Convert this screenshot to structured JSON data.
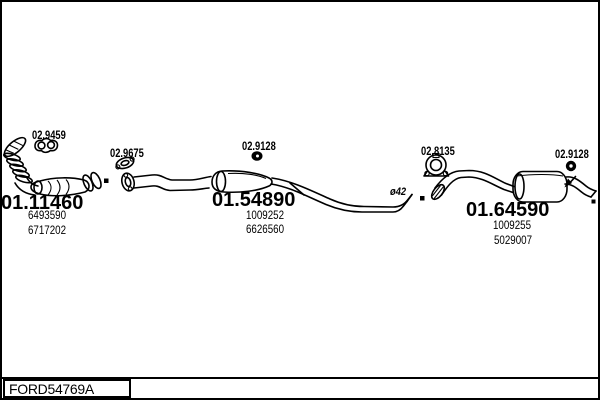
{
  "diagram": {
    "sections": {
      "front": {
        "part_id": "01.11460",
        "oe_refs": [
          "6493590",
          "6717202"
        ]
      },
      "center": {
        "part_id": "01.54890",
        "oe_refs": [
          "1009252",
          "6626560"
        ]
      },
      "rear": {
        "part_id": "01.64590",
        "oe_refs": [
          "1009255",
          "5029007"
        ]
      }
    },
    "fittings": {
      "front_gasket": "02.9459",
      "flange_gasket": "02.9675",
      "center_hanger": "02.9128",
      "pipe_clamp": "02.8135",
      "rear_hanger": "02.9128"
    },
    "annotations": {
      "pipe_diameter": "ø42"
    }
  },
  "footer": {
    "drawing_code": "FORD54769A"
  },
  "colors": {
    "line": "#000000",
    "background": "#ffffff"
  }
}
